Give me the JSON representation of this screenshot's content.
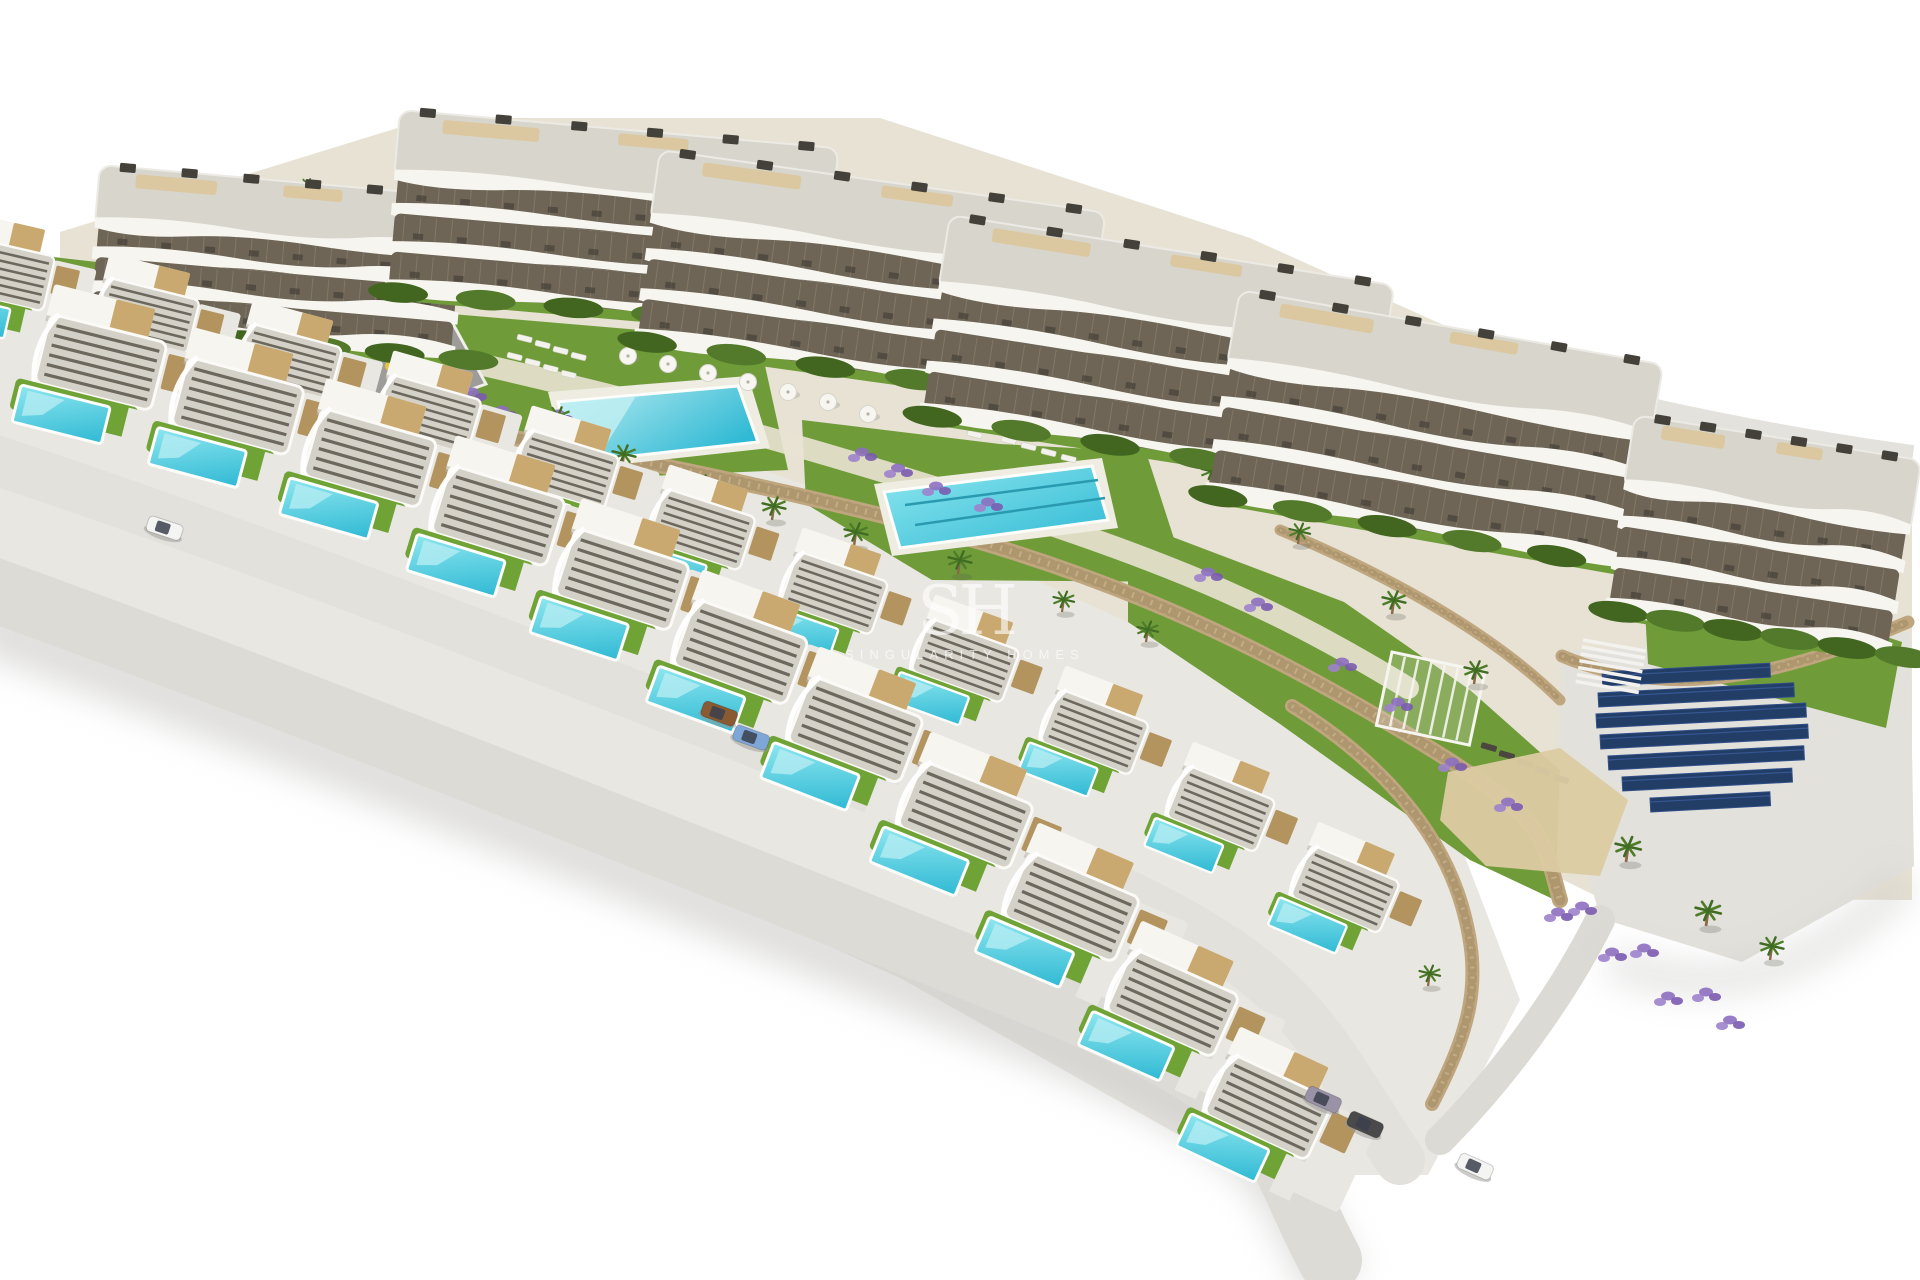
{
  "watermark": {
    "initials": "SH",
    "name": "SINGULARITY HOMES"
  },
  "palette": {
    "background": "#ffffff",
    "terrain_sand": "#e7e2d4",
    "terrain_concrete": "#e9e7e1",
    "building_white": "#f6f5f0",
    "building_roof": "#d8d5cc",
    "building_window": "#6e6556",
    "roof_terrace_beige": "#dbc8a0",
    "grass": "#6f9c39",
    "hedge_dark": "#42661f",
    "stone_wall": "#bfa67e",
    "pool_turquoise": "#2fb9d4",
    "pool_light": "#8ee7ef",
    "plaza_gray": "#9d9c98",
    "road_gray": "#dddbd5",
    "lavender": "#8d6fc0",
    "palm_green": "#4e7d2a",
    "solar_navy": "#223d66",
    "sand_patch": "#dccba2",
    "shadow": "#c9c8c6"
  },
  "scene": {
    "canvas": {
      "w": 1920,
      "h": 1280
    },
    "terrain": {
      "upper": "60,232 430,118 880,118 1250,238 1650,418 1912,515 1912,900 1600,898 1200,700 700,478 300,378 60,332",
      "villaBand": "0,250 150,268 500,378 900,518 1250,678 1450,818 1520,1000 1428,1175 1250,1175 900,978 500,798 150,638 0,578",
      "pad": "1562,652 1910,632 1914,866 1742,962 1600,918 1558,760",
      "padPath": "M1600,920 C1560,1000 1500,1080 1440,1140",
      "sand": "1448,772 1560,748 1628,800 1600,876 1486,866 1440,820"
    },
    "roads": {
      "top": "M1120,268 C1350,335 1600,420 1912,462",
      "inner": "M-20,455 C300,560 700,720 1000,840 S1300,1010 1400,1160",
      "front": "M-20,585 C300,700 700,860 1000,980 S1260,1130 1330,1260",
      "walk": "M470,362 C640,400 820,450 1000,508 S1280,610 1408,688",
      "shadowFront": "M-20,622 C300,740 700,900 1000,1020 S1270,1170 1335,1285",
      "shadowRight": "M1610,960 C1720,1010 1830,960 1905,880"
    },
    "lawns": [
      "428,312 640,330 762,352 788,470 604,478 430,398",
      "802,420 1000,444 1146,452 1188,582 932,580 806,504",
      "1128,520 1344,602 1470,690 1560,770 1555,900 1470,860 1280,724 1128,622",
      "1642,556 1902,642 1886,728 1648,664",
      "44,256 238,278 252,332 62,334"
    ],
    "plaza": {
      "points": "242,332 452,322 486,384 420,408 292,410 246,372",
      "items": [
        {
          "x": 316,
          "y": 362,
          "c": "#e8c53a"
        },
        {
          "x": 352,
          "y": 372,
          "c": "#d46a2a"
        },
        {
          "x": 390,
          "y": 366,
          "c": "#e8c53a"
        },
        {
          "x": 332,
          "y": 386,
          "c": "#777770"
        }
      ]
    },
    "walls": [
      {
        "d": "M285,405 C500,430 700,470 900,520 S1250,640 1400,730 S1540,830 1560,900",
        "w": 16
      },
      {
        "d": "M60,330 C200,350 280,365 350,385",
        "w": 12
      },
      {
        "d": "M950,300 C1100,340 1200,390 1290,440",
        "w": 11
      },
      {
        "d": "M1280,530 C1400,580 1500,640 1560,700",
        "w": 11
      },
      {
        "d": "M1292,706 C1380,760 1440,830 1462,906 S1470,1030 1432,1104",
        "w": 14
      },
      {
        "d": "M1562,656 C1680,706 1800,668 1908,622",
        "w": 13
      }
    ],
    "pools": {
      "lagoon": {
        "deck": "548,392 748,376 770,448 568,470",
        "body": "558,402 738,386 758,442 578,462",
        "beach": "560,403 636,396 598,458 578,460"
      },
      "lap": {
        "deck": "874,484 1102,458 1118,528 892,556",
        "body": "884,492 1092,466 1108,520 900,548",
        "lanes": [
          "905,505 1098,480",
          "915,525 1105,498"
        ]
      }
    },
    "buildings": [
      {
        "x": 100,
        "y": 165,
        "w": 370,
        "h": 160,
        "rot": 5
      },
      {
        "x": 400,
        "y": 110,
        "w": 440,
        "h": 180,
        "rot": 5
      },
      {
        "x": 660,
        "y": 150,
        "w": 450,
        "h": 190,
        "rot": 8
      },
      {
        "x": 950,
        "y": 215,
        "w": 450,
        "h": 200,
        "rot": 9
      },
      {
        "x": 1240,
        "y": 290,
        "w": 430,
        "h": 205,
        "rot": 10
      },
      {
        "x": 1635,
        "y": 415,
        "w": 290,
        "h": 195,
        "rot": 9
      }
    ],
    "villas": {
      "front": [
        {
          "x": 55,
          "y": 315,
          "rot": 14,
          "s": 1
        },
        {
          "x": 193,
          "y": 358,
          "rot": 15,
          "s": 1
        },
        {
          "x": 326,
          "y": 409,
          "rot": 16,
          "s": 1
        },
        {
          "x": 455,
          "y": 466,
          "rot": 17,
          "s": 1
        },
        {
          "x": 580,
          "y": 529,
          "rot": 18,
          "s": 1
        },
        {
          "x": 700,
          "y": 600,
          "rot": 20,
          "s": 1
        },
        {
          "x": 816,
          "y": 677,
          "rot": 21,
          "s": 1
        },
        {
          "x": 927,
          "y": 762,
          "rot": 22,
          "s": 1
        },
        {
          "x": 1034,
          "y": 853,
          "rot": 23,
          "s": 1
        },
        {
          "x": 1137,
          "y": 950,
          "rot": 24,
          "s": 0.97
        },
        {
          "x": 1235,
          "y": 1055,
          "rot": 25,
          "s": 0.94
        }
      ],
      "back": [
        {
          "x": -35,
          "y": 236,
          "rot": 13,
          "s": 0.8
        },
        {
          "x": 110,
          "y": 278,
          "rot": 14,
          "s": 0.8
        },
        {
          "x": 253,
          "y": 324,
          "rot": 15,
          "s": 0.8
        },
        {
          "x": 393,
          "y": 375,
          "rot": 16,
          "s": 0.8
        },
        {
          "x": 531,
          "y": 430,
          "rot": 17,
          "s": 0.8
        },
        {
          "x": 668,
          "y": 489,
          "rot": 18,
          "s": 0.8
        },
        {
          "x": 801,
          "y": 552,
          "rot": 19,
          "s": 0.8
        },
        {
          "x": 933,
          "y": 619,
          "rot": 20,
          "s": 0.8
        },
        {
          "x": 1063,
          "y": 690,
          "rot": 21,
          "s": 0.8
        },
        {
          "x": 1190,
          "y": 766,
          "rot": 22,
          "s": 0.8
        },
        {
          "x": 1315,
          "y": 846,
          "rot": 23,
          "s": 0.8
        }
      ]
    },
    "palms": [
      [
        556,
        430,
        1
      ],
      [
        622,
        468,
        1
      ],
      [
        700,
        498,
        1
      ],
      [
        772,
        520,
        1
      ],
      [
        854,
        546,
        1
      ],
      [
        958,
        574,
        1
      ],
      [
        1062,
        612,
        0.9
      ],
      [
        1146,
        642,
        0.9
      ],
      [
        906,
        382,
        0.8
      ],
      [
        1014,
        424,
        0.8
      ],
      [
        1210,
        484,
        0.9
      ],
      [
        1298,
        544,
        0.9
      ],
      [
        1392,
        614,
        1
      ],
      [
        1474,
        684,
        1
      ],
      [
        1626,
        862,
        1.1
      ],
      [
        1706,
        926,
        1.1
      ],
      [
        306,
        196,
        0.75
      ],
      [
        486,
        236,
        0.75
      ],
      [
        1254,
        1146,
        0.9
      ],
      [
        1428,
        986,
        0.9
      ],
      [
        1840,
        598,
        0.8
      ],
      [
        130,
        306,
        0.7
      ]
    ],
    "lavender": [
      [
        472,
        392
      ],
      [
        502,
        410
      ],
      [
        862,
        452
      ],
      [
        898,
        468
      ],
      [
        988,
        502
      ],
      [
        1208,
        572
      ],
      [
        1258,
        602
      ],
      [
        1342,
        662
      ],
      [
        1398,
        702
      ],
      [
        124,
        332
      ],
      [
        1582,
        906
      ],
      [
        1644,
        948
      ],
      [
        1706,
        992
      ],
      [
        344,
        398
      ],
      [
        1452,
        762
      ],
      [
        1508,
        802
      ],
      [
        558,
        414
      ],
      [
        936,
        486
      ]
    ],
    "umbrellas": [
      [
        628,
        356
      ],
      [
        668,
        364
      ],
      [
        708,
        373
      ],
      [
        748,
        382
      ],
      [
        788,
        392
      ],
      [
        828,
        402
      ],
      [
        868,
        414
      ]
    ],
    "loungers": [
      [
        518,
        334,
        14
      ],
      [
        536,
        340,
        14
      ],
      [
        554,
        346,
        14
      ],
      [
        572,
        352,
        14
      ],
      [
        508,
        352,
        14
      ],
      [
        526,
        358,
        14
      ],
      [
        544,
        364,
        14
      ],
      [
        562,
        370,
        14
      ],
      [
        1002,
        436,
        14
      ],
      [
        1022,
        442,
        14
      ],
      [
        1042,
        448,
        14
      ],
      [
        1062,
        454,
        14
      ],
      [
        968,
        430,
        14
      ]
    ],
    "loungersDark": [
      [
        1482,
        742,
        16
      ],
      [
        1500,
        750,
        16
      ],
      [
        1518,
        758,
        16
      ],
      [
        1536,
        766,
        16
      ],
      [
        1554,
        774,
        16
      ]
    ],
    "cars": [
      {
        "x": 150,
        "y": 515,
        "rot": 18,
        "color": "#f4f4f2"
      },
      {
        "x": 705,
        "y": 700,
        "rot": 20,
        "color": "#8a5a33"
      },
      {
        "x": 737,
        "y": 724,
        "rot": 20,
        "color": "#7ea7d8"
      },
      {
        "x": 1310,
        "y": 1085,
        "rot": 24,
        "color": "#9a93a8"
      },
      {
        "x": 1352,
        "y": 1110,
        "rot": 24,
        "color": "#4a4a4a"
      },
      {
        "x": 1462,
        "y": 1152,
        "rot": 24,
        "color": "#f4f4f2"
      }
    ],
    "solar": {
      "rot": -3,
      "panels": [
        [
          1602,
          672,
          168
        ],
        [
          1598,
          693,
          196
        ],
        [
          1596,
          714,
          210
        ],
        [
          1600,
          735,
          208
        ],
        [
          1608,
          756,
          196
        ],
        [
          1622,
          777,
          170
        ],
        [
          1650,
          798,
          120
        ]
      ]
    },
    "pergola": {
      "x": 1392,
      "y": 652,
      "w": 95,
      "h": 75,
      "rot": 12
    },
    "stairs": {
      "x": 1583,
      "y": 640,
      "rot": 10,
      "n": 7
    }
  }
}
